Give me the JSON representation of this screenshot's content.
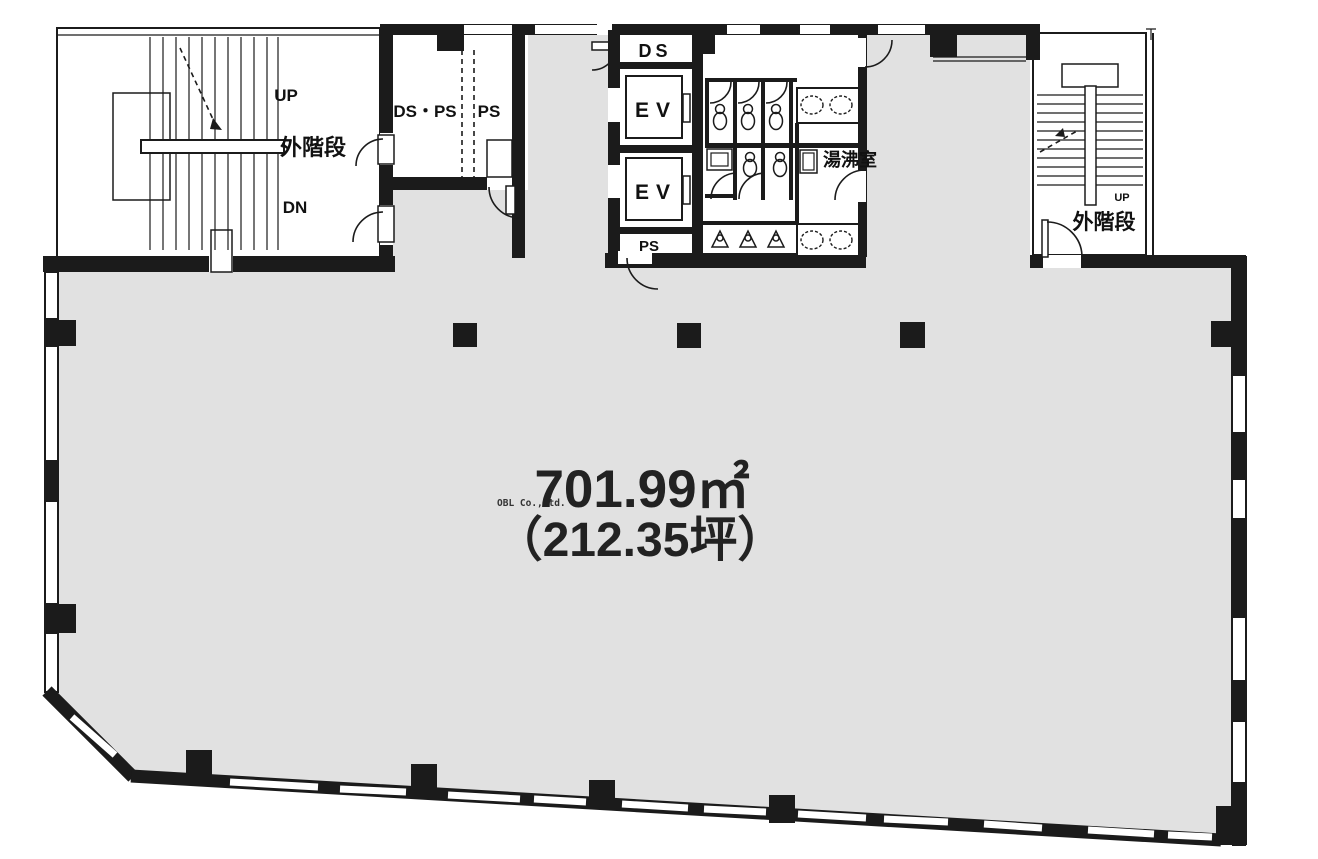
{
  "colors": {
    "floor_gray": "#e1e1e1",
    "wall_black": "#1b1b1b",
    "background": "#ffffff"
  },
  "labels": {
    "stair_left": {
      "up": "UP",
      "name": "外階段",
      "down": "DN"
    },
    "duct_room": {
      "left": "DS・PS",
      "right": "PS"
    },
    "top_duct": "DS",
    "elevator_core": {
      "elevator1": "EV",
      "elevator2": "EV",
      "pipe_shaft": "PS"
    },
    "kitchenette": "湯沸室",
    "stair_right": {
      "up": "UP",
      "name": "外階段"
    },
    "area": {
      "square_meters": "701.99㎡",
      "tsubo": "（212.35坪）"
    },
    "watermark": "OBL Co.,Ltd."
  }
}
